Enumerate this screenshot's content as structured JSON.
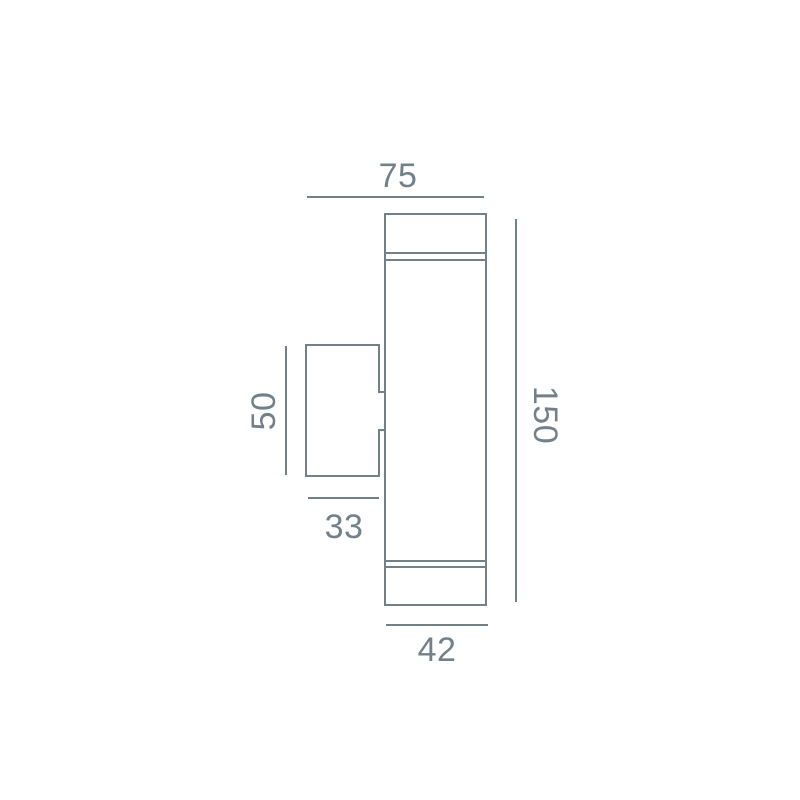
{
  "page": {
    "background_color": "#ffffff"
  },
  "drawing": {
    "kind": "dimension-drawing",
    "line_color": "#72808a",
    "text_color": "#72808a",
    "labels": {
      "total_depth": "75",
      "body_height": "150",
      "bracket_height": "50",
      "bracket_depth": "33",
      "body_diameter": "42"
    }
  }
}
